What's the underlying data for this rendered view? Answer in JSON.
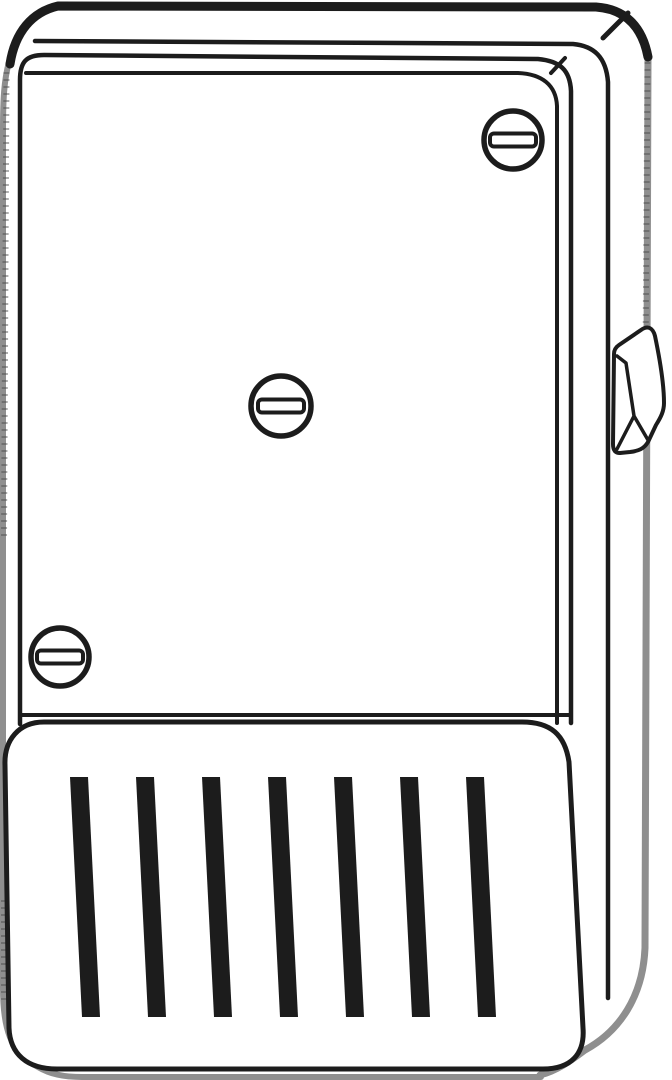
{
  "illustration": {
    "description": "black-and-white technical line drawing of an electrical timer enclosure box, three-quarter view",
    "colors": {
      "background": "#ffffff",
      "line": "#1c1c1c",
      "edge_shade": "#8f8f8f",
      "edge_hatch": "#4a4a4a"
    },
    "parts": [
      "enclosure-body",
      "front-panel",
      "front-door",
      "slotted-screws",
      "side-lever",
      "vent-cover",
      "vent-slats"
    ],
    "screws": [
      {
        "cx": 513,
        "cy": 140,
        "r": 29
      },
      {
        "cx": 281,
        "cy": 406,
        "r": 30
      },
      {
        "cx": 60,
        "cy": 657,
        "r": 29
      }
    ],
    "screw_slot": {
      "width": 46,
      "height": 13,
      "corner_radius": 4,
      "stroke": 4
    },
    "screw_ring_stroke": 5.5,
    "vents": {
      "count": 7,
      "first_x": 70,
      "spacing": 66,
      "bar_width": 18,
      "top_y": 777,
      "bottom_y": 1017,
      "lean_x": 12
    }
  }
}
